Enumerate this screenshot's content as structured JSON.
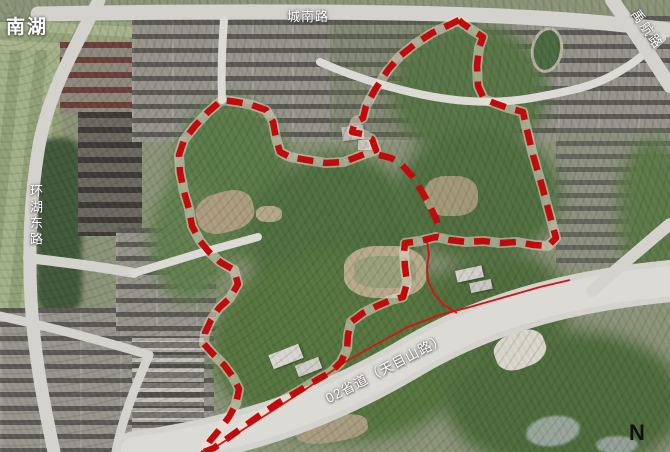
{
  "page": {
    "width": 670,
    "height": 452,
    "type": "satellite-planning-map"
  },
  "labels": {
    "lake": "南湖",
    "top_road": "城南路",
    "left_road": "环湖东路",
    "diagonal_road": "02省道（天目山路）",
    "top_right_road": "禹航路",
    "north_indicator": "N"
  },
  "boundary": {
    "color": "#bf0b0b",
    "underlay_color": "#efddd2",
    "style": "thick red dashed outline with thin solid red road-edge lines",
    "outline": "459,20 447,26 432,33 415,44 400,56 388,70 376,88 366,106 363,118 355,122 352,132 362,134 372,139 376,150 362,155 344,162 326,163 307,160 290,157 280,152 276,138 273,122 266,110 252,105 237,102 222,100 208,112 195,126 184,140 179,155 180,172 184,192 189,209 192,226 200,241 209,252 220,262 234,270 238,284 230,298 219,308 211,320 205,333 204,344 213,354 224,365 233,377 239,389 236,404 229,417 220,429 210,441 204,452 214,448 228,438 242,428 260,415 278,403 297,392 315,381 331,372 341,362 347,349 348,335 351,322 363,313 377,306 391,300 403,297 407,283 405,267 404,252 405,243 420,241 436,237 450,240 466,242 483,241 500,243 517,242 534,245 548,246 556,238 550,216 542,186 533,155 526,126 523,112 508,108 494,103 484,99 478,86 477,66 479,48 483,37 472,30 462,23 459,20",
    "divider": "379,155 391,158 401,164 412,176 421,190 429,204 436,219 441,233",
    "access_loop": "427,241 429,254 427,268 428,281 434,294 444,305 457,313",
    "road_edge_line": "204,452 214,448 244,429 280,406 315,383 345,362 375,345 408,327 440,315 470,307 505,297 540,287 570,280"
  }
}
